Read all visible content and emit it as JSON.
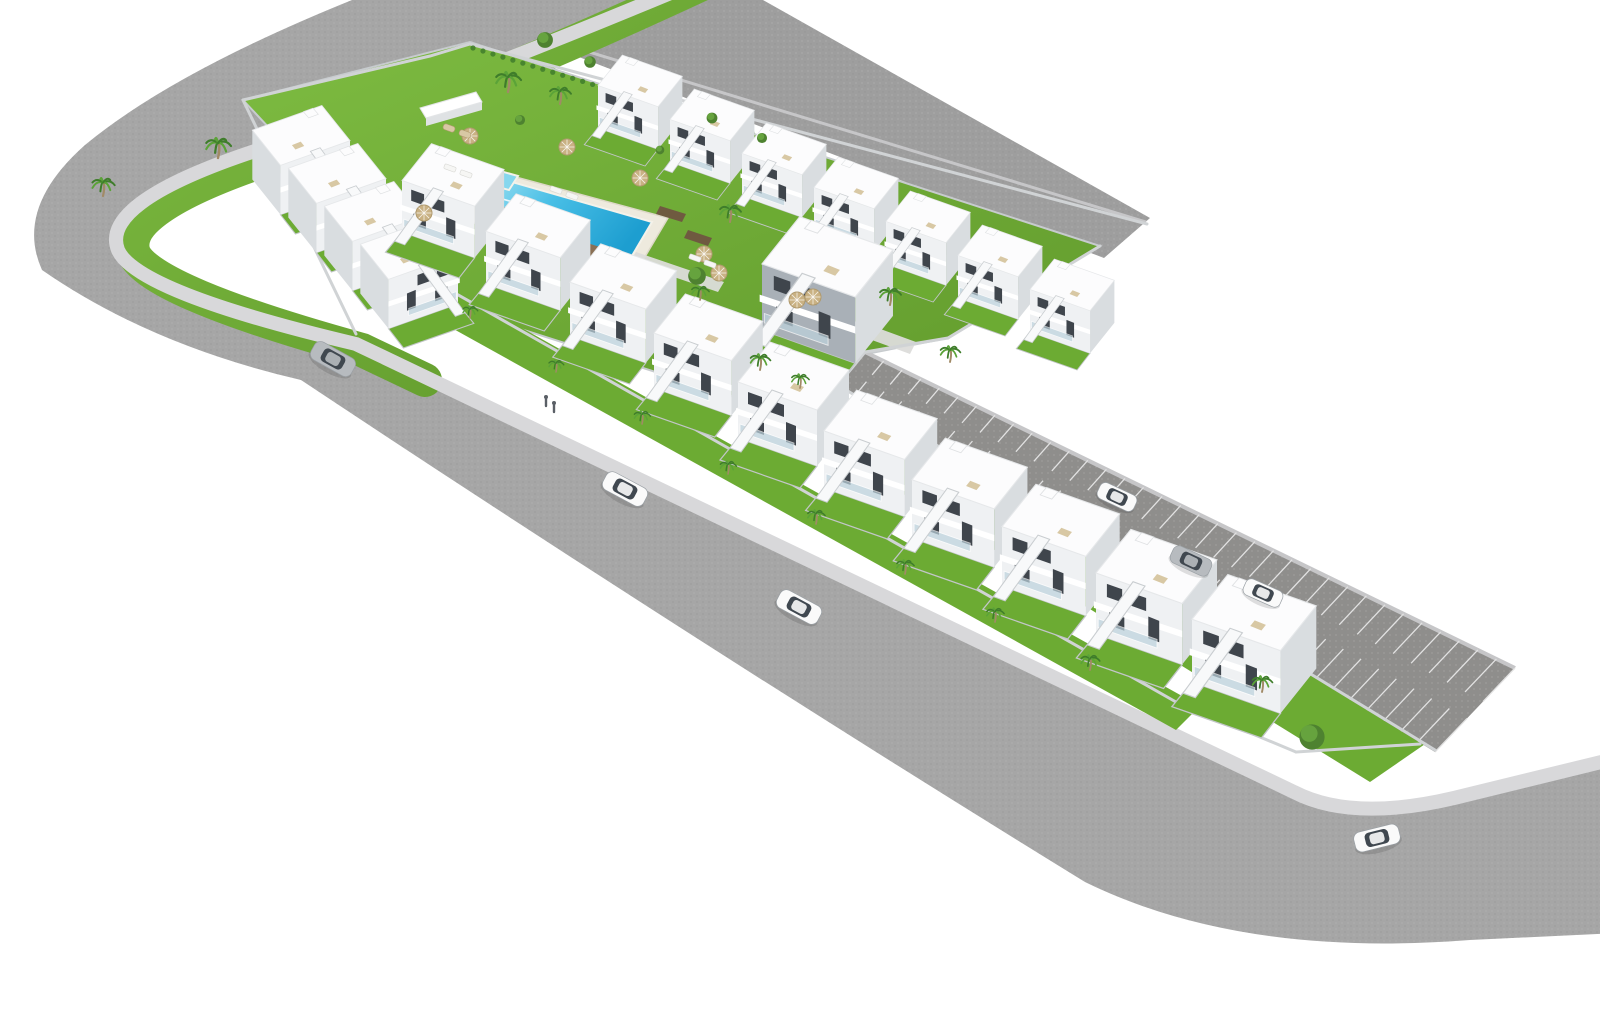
{
  "scene": {
    "kind": "aerial-3d-render",
    "description": "Aerial 3D architectural rendering of an L-shaped residential development with white two-storey townhouses, a central landscaped courtyard with swimming pool, perimeter roads and a parking strip",
    "width": 1600,
    "height": 1024
  },
  "palette": {
    "background": "#ffffff",
    "road": "#a6a6a6",
    "road_top": "#9e9e9e",
    "sidewalk": "#d8d8da",
    "curb": "#c6c6c8",
    "parking_asphalt": "#8f8e8c",
    "stall_line": "#e2e2e2",
    "grass_light": "#7dbb41",
    "grass_dark": "#619a2c",
    "garden_grass": "#6cab33",
    "wall": "#d0d3d5",
    "house_white": "#fcfcfd",
    "house_front": "#eff1f3",
    "house_side": "#d9dde0",
    "window": "#3f454c",
    "glass": "#bdd3dd",
    "stair": "#f8f9fa",
    "accent_front": "#a9b0b7",
    "pool_deck": "#eeeade",
    "pool_edge": "#c3b184",
    "water_light": "#a5e3f2",
    "water_mid": "#49bfe6",
    "water_deep": "#1d9ed0",
    "kids_water": "#86d7ee",
    "deck_wood": "#8a7055",
    "step_wood": "#6f5a40",
    "path_light": "#dcdcda",
    "palm_dark": "#3f7d2b",
    "palm_light": "#5ba338",
    "trunk": "#a18a66",
    "bush": "#4e8230",
    "bush_hi": "#66a33e",
    "umbrella": "#c9b183",
    "furniture_tan": "#d8c8a4",
    "lounger_white": "#f6f6f4",
    "car_white": "#fafafa",
    "car_silver": "#b7bbbf",
    "car_glass": "#404850",
    "person": "#5a5f66"
  },
  "roads": {
    "main_d": "M 712,-30 Q 430,90 240,150 Q 95,200 112,248 Q 130,292 352,340 L 1292,788 Q 1352,820 1455,795 L 1640,750 L 1640,932 L 1470,940 Q 1240,958 1085,882 Q 700,645 301,380 Q 150,345 42,270 Q 14,208 85,145 Q 190,58 430,-30 Z",
    "top_polygon": [
      [
        430,
        0
      ],
      [
        763,
        0
      ],
      [
        1150,
        218
      ],
      [
        1104,
        258
      ]
    ],
    "top_curb": [
      [
        432,
        4
      ],
      [
        1146,
        222
      ]
    ],
    "sidewalk_d": "M 716,-26 Q 436,92 246,154 Q 100,204 118,250 Q 136,292 356,344 L 1294,792 Q 1352,822 1454,798 L 1642,752",
    "verge_d": "M 702,-16 Q 440,106 254,164 Q 118,212 134,254 Q 152,292 362,350 L 425,380"
  },
  "parking": {
    "ne_edge": [
      [
        865,
        352
      ],
      [
        1515,
        668
      ]
    ],
    "sw_edge": [
      [
        838,
        385
      ],
      [
        1435,
        752
      ]
    ],
    "stall_count": 35,
    "stall_inner_frac": 0.4
  },
  "pool": {
    "deck": [
      [
        460,
        162
      ],
      [
        668,
        218
      ],
      [
        636,
        272
      ],
      [
        432,
        210
      ]
    ],
    "water": [
      [
        498,
        178
      ],
      [
        652,
        222
      ],
      [
        626,
        266
      ],
      [
        476,
        220
      ]
    ],
    "edge_band": [
      [
        476,
        220
      ],
      [
        626,
        266
      ],
      [
        628,
        274
      ],
      [
        478,
        228
      ]
    ],
    "steps": [
      [
        [
          492,
          196
        ],
        [
          520,
          204
        ]
      ],
      [
        [
          488,
          204
        ],
        [
          516,
          212
        ]
      ],
      [
        [
          484,
          212
        ],
        [
          512,
          220
        ]
      ]
    ],
    "kids_pool": [
      [
        482,
        166
      ],
      [
        518,
        176
      ],
      [
        509,
        190
      ],
      [
        473,
        180
      ]
    ],
    "wood_decks": [
      [
        [
          500,
          206
        ],
        [
          534,
          216
        ],
        [
          528,
          226
        ],
        [
          494,
          216
        ]
      ],
      [
        [
          584,
          242
        ],
        [
          616,
          252
        ],
        [
          610,
          262
        ],
        [
          578,
          252
        ]
      ]
    ],
    "dark_steps": [
      [
        [
          660,
          206
        ],
        [
          686,
          214
        ],
        [
          682,
          222
        ],
        [
          656,
          214
        ]
      ],
      [
        [
          688,
          230
        ],
        [
          712,
          238
        ],
        [
          708,
          246
        ],
        [
          684,
          238
        ]
      ]
    ],
    "light_paths": [
      [
        [
          636,
          252
        ],
        [
          724,
          282
        ],
        [
          718,
          292
        ],
        [
          630,
          262
        ]
      ],
      [
        [
          856,
          320
        ],
        [
          916,
          342
        ],
        [
          910,
          354
        ],
        [
          850,
          332
        ]
      ]
    ]
  },
  "greens": {
    "courtyard": [
      [
        243,
        100
      ],
      [
        470,
        42
      ],
      [
        1100,
        246
      ],
      [
        948,
        338
      ],
      [
        866,
        354
      ],
      [
        806,
        420
      ],
      [
        430,
        300
      ]
    ],
    "front_gardens": [
      [
        382,
        250
      ],
      [
        1200,
        706
      ],
      [
        1176,
        730
      ],
      [
        358,
        276
      ]
    ],
    "back_gardens": [
      [
        855,
        395
      ],
      [
        1428,
        742
      ],
      [
        1370,
        782
      ],
      [
        800,
        430
      ]
    ]
  },
  "walls": [
    [
      [
        243,
        100
      ],
      [
        430,
        56
      ],
      [
        470,
        44
      ]
    ],
    [
      [
        470,
        44
      ],
      [
        1147,
        224
      ]
    ],
    [
      [
        243,
        100
      ],
      [
        356,
        334
      ]
    ],
    [
      [
        386,
        254
      ],
      [
        1176,
        702
      ]
    ],
    [
      [
        1176,
        702
      ],
      [
        1296,
        752
      ]
    ],
    [
      [
        1296,
        752
      ],
      [
        1420,
        744
      ]
    ],
    [
      [
        838,
        385
      ],
      [
        1435,
        750
      ]
    ],
    [
      [
        865,
        352
      ],
      [
        838,
        385
      ]
    ],
    [
      [
        948,
        338
      ],
      [
        865,
        352
      ]
    ],
    [
      [
        1100,
        246
      ],
      [
        948,
        338
      ]
    ]
  ],
  "hedge": {
    "from": [
      473,
      48
    ],
    "to": [
      762,
      136
    ],
    "count": 30
  },
  "pergolas": [
    {
      "top": [
        [
          420,
          108
        ],
        [
          476,
          92
        ],
        [
          482,
          102
        ],
        [
          426,
          118
        ]
      ],
      "side": [
        [
          426,
          118
        ],
        [
          482,
          102
        ],
        [
          482,
          110
        ],
        [
          426,
          126
        ]
      ]
    }
  ],
  "houses": {
    "top_row": {
      "scale": 0.76,
      "flip": false,
      "positions": [
        [
          598,
          128
        ],
        [
          670,
          162
        ],
        [
          742,
          196
        ],
        [
          814,
          230
        ],
        [
          886,
          264
        ],
        [
          958,
          298
        ],
        [
          1030,
          332
        ]
      ]
    },
    "left_row": {
      "scale": 0.88,
      "flip": true,
      "positions": [
        [
          350,
          190
        ],
        [
          386,
          228
        ],
        [
          422,
          266
        ],
        [
          458,
          304
        ]
      ]
    },
    "chain": {
      "flip": false,
      "positions": [
        [
          402,
          232,
          0.92
        ],
        [
          486,
          284,
          0.94
        ],
        [
          570,
          336,
          0.96
        ],
        [
          654,
          388,
          0.98
        ],
        [
          738,
          438,
          1.0
        ],
        [
          824,
          488,
          1.02
        ],
        [
          912,
          538,
          1.04
        ],
        [
          1002,
          586,
          1.06
        ],
        [
          1096,
          634,
          1.09
        ],
        [
          1192,
          682,
          1.12
        ]
      ]
    },
    "center_building": {
      "x": 762,
      "y": 330,
      "scale": 1.18
    }
  },
  "vegetation": {
    "palms": [
      [
        218,
        158,
        1.0
      ],
      [
        103,
        196,
        0.9
      ],
      [
        508,
        92,
        1.0
      ],
      [
        560,
        104,
        0.85
      ],
      [
        730,
        222,
        0.85
      ],
      [
        700,
        300,
        0.7
      ],
      [
        890,
        305,
        0.85
      ],
      [
        950,
        362,
        0.8
      ],
      [
        760,
        370,
        0.8
      ],
      [
        800,
        388,
        0.7
      ],
      [
        470,
        318,
        0.6
      ],
      [
        556,
        372,
        0.6
      ],
      [
        642,
        424,
        0.65
      ],
      [
        728,
        474,
        0.65
      ],
      [
        816,
        524,
        0.7
      ],
      [
        905,
        574,
        0.7
      ],
      [
        995,
        622,
        0.7
      ],
      [
        1090,
        670,
        0.75
      ],
      [
        1262,
        692,
        0.8
      ]
    ],
    "bushes": [
      [
        545,
        40,
        1.1
      ],
      [
        590,
        62,
        0.8
      ],
      [
        520,
        120,
        0.7
      ],
      [
        712,
        118,
        0.75
      ],
      [
        762,
        138,
        0.7
      ],
      [
        660,
        150,
        0.6
      ]
    ],
    "round_trees": [
      [
        1312,
        737,
        1.0
      ],
      [
        697,
        276,
        0.7
      ]
    ]
  },
  "furniture": {
    "umbrellas": [
      [
        470,
        136
      ],
      [
        567,
        147
      ],
      [
        640,
        178
      ],
      [
        424,
        213
      ],
      [
        704,
        254
      ],
      [
        719,
        273
      ],
      [
        797,
        300
      ],
      [
        813,
        297
      ]
    ],
    "loungers": [
      [
        450,
        168
      ],
      [
        466,
        174
      ],
      [
        556,
        190
      ],
      [
        572,
        196
      ],
      [
        695,
        258
      ],
      [
        710,
        264
      ]
    ],
    "sunbeds": [
      [
        449,
        128
      ],
      [
        465,
        134
      ]
    ]
  },
  "people": [
    [
      546,
      402
    ],
    [
      554,
      408
    ]
  ],
  "cars": [
    {
      "x": 333,
      "y": 359,
      "angle": 29,
      "len": 46,
      "color": "silver",
      "where": "road"
    },
    {
      "x": 625,
      "y": 489,
      "angle": 28,
      "len": 46,
      "color": "white",
      "where": "road"
    },
    {
      "x": 799,
      "y": 607,
      "angle": 28,
      "len": 46,
      "color": "white",
      "where": "road"
    },
    {
      "x": 1377,
      "y": 838,
      "angle": -14,
      "len": 46,
      "color": "white",
      "where": "road"
    },
    {
      "x": 1117,
      "y": 497,
      "angle": 25,
      "len": 40,
      "color": "white",
      "where": "parking"
    },
    {
      "x": 1191,
      "y": 561,
      "angle": 25,
      "len": 42,
      "color": "silver",
      "where": "parking"
    },
    {
      "x": 1263,
      "y": 593,
      "angle": 24,
      "len": 40,
      "color": "white",
      "where": "parking"
    }
  ]
}
